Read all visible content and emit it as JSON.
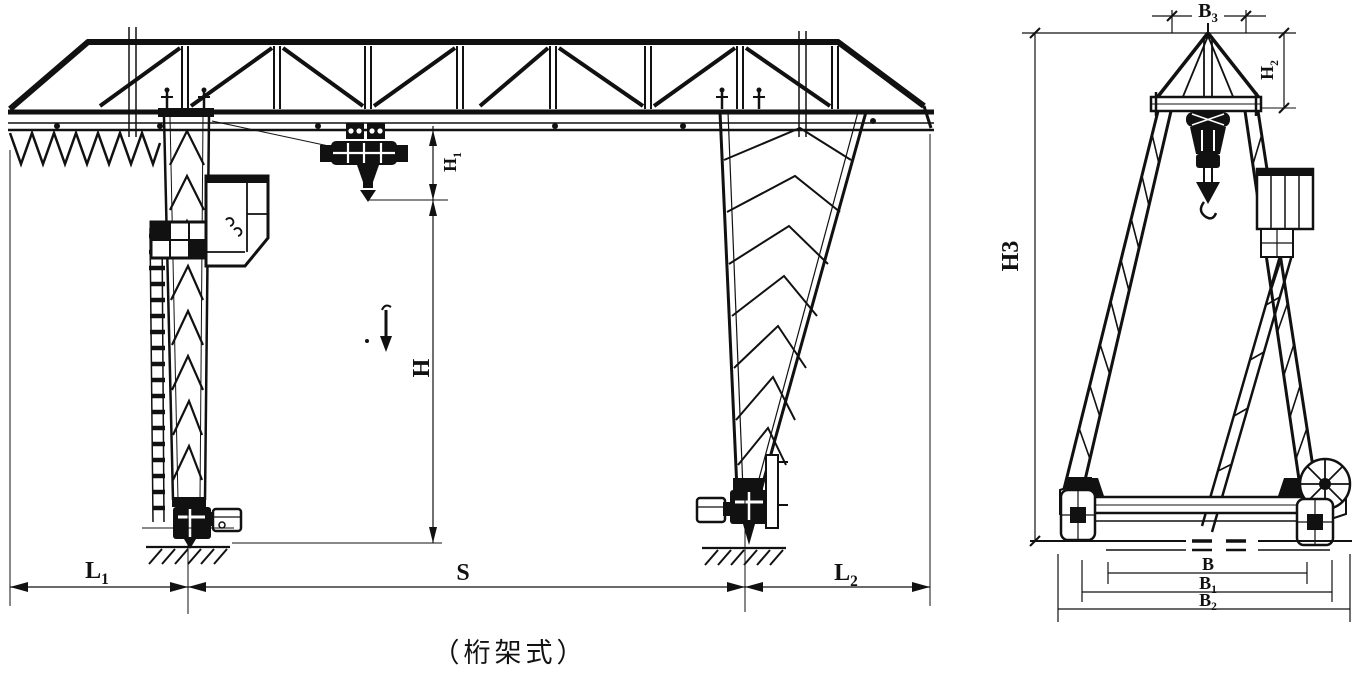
{
  "colors": {
    "ink": "#111111",
    "paper": "#ffffff"
  },
  "caption": "（桁架式）",
  "labels": {
    "l1": {
      "base": "L",
      "sub": "1"
    },
    "s": {
      "base": "S"
    },
    "l2": {
      "base": "L",
      "sub": "2"
    },
    "h": {
      "base": "H"
    },
    "h1": {
      "base": "H",
      "sub": "1"
    },
    "h2": {
      "base": "H",
      "sub": "2"
    },
    "h3": {
      "base": "H3"
    },
    "b": {
      "base": "B"
    },
    "b1": {
      "base": "B",
      "sub": "1"
    },
    "b2": {
      "base": "B",
      "sub": "2"
    },
    "b3": {
      "base": "B",
      "sub": "3"
    }
  }
}
